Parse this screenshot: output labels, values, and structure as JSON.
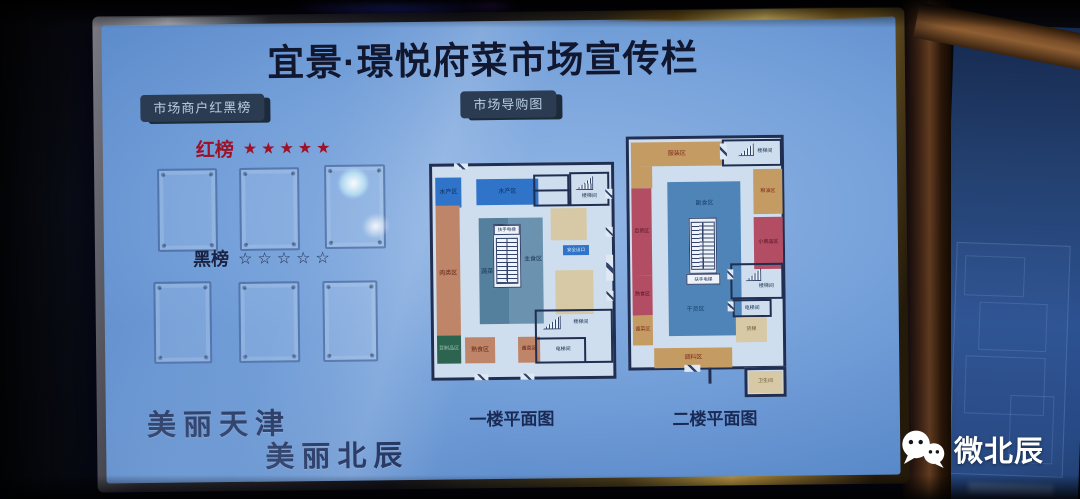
{
  "board": {
    "title": "宜景·璟悦府菜市场宣传栏",
    "red_black": {
      "badge": "市场商户红黑榜",
      "red_label": "红榜",
      "red_stars": "★★★★★",
      "black_label": "黑榜",
      "black_stars": "☆☆☆☆☆"
    },
    "guide": {
      "badge": "市场导购图",
      "floor1": {
        "caption": "一楼平面图",
        "rooms": [
          {
            "label": "水产区"
          },
          {
            "label": "水产区"
          },
          {
            "label": "楼梯间"
          },
          {
            "label": "肉类区"
          },
          {
            "label": "豆制品区"
          },
          {
            "label": "熟食区"
          },
          {
            "label": "酱菜区"
          },
          {
            "label": "蔬菜区"
          },
          {
            "label": "主食区"
          },
          {
            "label": "扶手电梯"
          },
          {
            "label": "安全出口"
          },
          {
            "label": "楼梯间"
          },
          {
            "label": "电梯间"
          }
        ]
      },
      "floor2": {
        "caption": "二楼平面图",
        "rooms": [
          {
            "label": "服装区"
          },
          {
            "label": "楼梯间"
          },
          {
            "label": "粮油区"
          },
          {
            "label": "小商品区"
          },
          {
            "label": "百货区"
          },
          {
            "label": "熟食区"
          },
          {
            "label": "酱菜区"
          },
          {
            "label": "调料区"
          },
          {
            "label": "副食区"
          },
          {
            "label": "干货区"
          },
          {
            "label": "扶手电梯"
          },
          {
            "label": "楼梯间"
          },
          {
            "label": "电梯间"
          },
          {
            "label": "货梯"
          },
          {
            "label": "卫生间"
          }
        ]
      }
    },
    "slogan": {
      "line1": "美丽天津",
      "line2": "美丽北辰"
    }
  },
  "watermark": {
    "label": "微北辰"
  },
  "colors": {
    "board_blue": "#6f9cd6",
    "list_red": "#9c1228",
    "navy": "#1c2a4e",
    "frame_gold": "#b89440"
  }
}
